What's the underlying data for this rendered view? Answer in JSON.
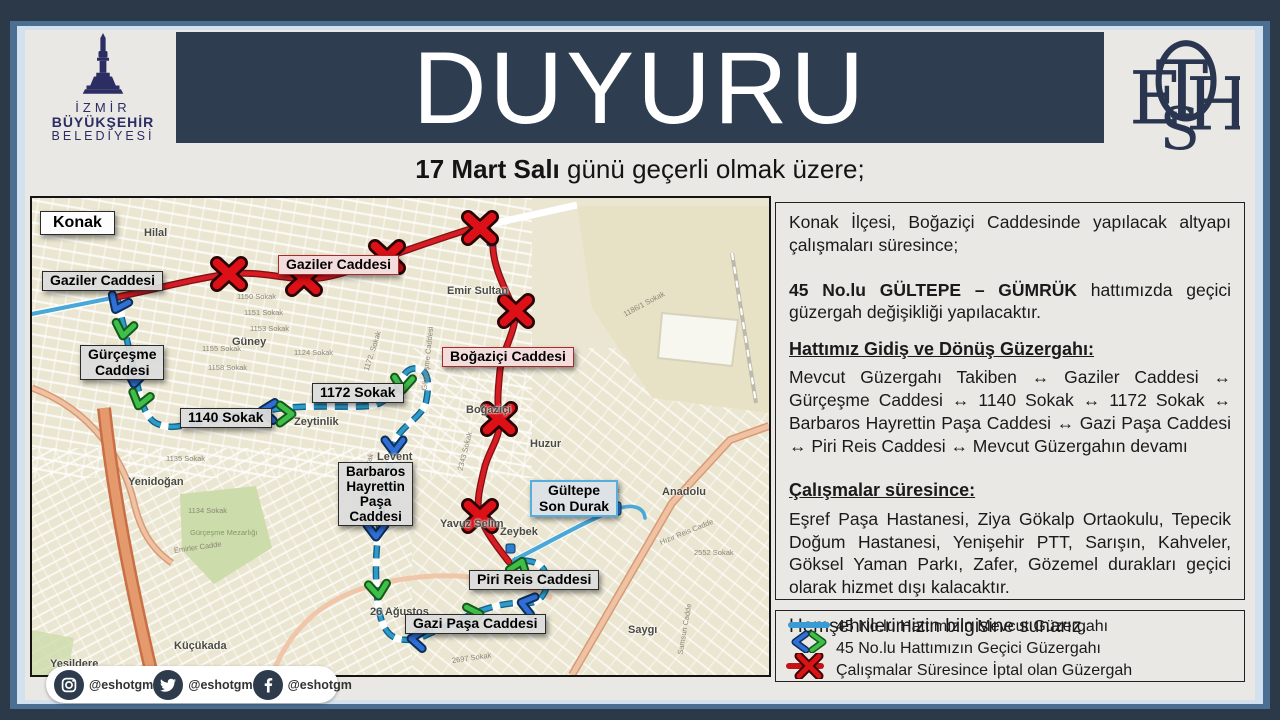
{
  "header": {
    "municipality": {
      "line1": "İZMİR",
      "line2": "BÜYÜKŞEHİR",
      "line3": "BELEDİYESİ"
    },
    "title": "DUYURU",
    "subtitle_bold": "17 Mart Salı",
    "subtitle_rest": " günü geçerli olmak üzere;",
    "eshot_letters": {
      "e": "E",
      "t": "T",
      "h": "H",
      "s": "S"
    }
  },
  "map": {
    "labels": {
      "konak": "Konak",
      "gaziler_left": "Gaziler Caddesi",
      "gaziler_center": "Gaziler Caddesi",
      "gurcesme": "Gürçeşme\nCaddesi",
      "sokak_1140": "1140 Sokak",
      "sokak_1172": "1172 Sokak",
      "bogazici": "Boğaziçi Caddesi",
      "barbaros": "Barbaros\nHayrettin\nPaşa\nCaddesi",
      "gultepe": "Gültepe\nSon Durak",
      "piri_reis": "Piri Reis Caddesi",
      "gazi_pasa": "Gazi Paşa Caddesi"
    },
    "places": [
      "Hilal",
      "Güney",
      "Emir Sultan",
      "Zeytinlik",
      "Levent",
      "Yenidoğan",
      "Küçükada",
      "Yeşildere",
      "Boğaziçi",
      "Huzur",
      "Anadolu",
      "Zeybek",
      "Yavuz Selim",
      "26 Ağustos",
      "Saygı"
    ],
    "streets": [
      "1150 Sokak",
      "1151 Sokak",
      "1153 Sokak",
      "1155 Sokak",
      "1158 Sokak",
      "1124 Sokak",
      "1135 Sokak",
      "1134 Sokak",
      "1172. Sokak",
      "Gürçeşme Caddesi",
      "Gürçeşme Mezarlığı",
      "2430 Sokak",
      "2552 Sokak",
      "Emirler Cadde",
      "1163 Sokak",
      "2343 Sokak",
      "1186/1 Sokak",
      "2697 Sokak",
      "Hızır Reis Cadde",
      "Samsun Cadde"
    ]
  },
  "panel": {
    "p1": "Konak İlçesi, Boğaziçi Caddesinde yapılacak altyapı çalışmaları süresince;",
    "p2_bold": "45 No.lu GÜLTEPE – GÜMRÜK",
    "p2_rest": " hattımızda geçici güzergah değişikliği yapılacaktır.",
    "h1": "Hattımız Gidiş ve Dönüş Güzergahı:",
    "route": "Mevcut Güzergahı Takiben ↔ Gaziler Caddesi ↔ Gürçeşme Caddesi ↔ 1140 Sokak ↔ 1172 Sokak ↔ Barbaros Hayrettin Paşa Caddesi ↔ Gazi Paşa Caddesi ↔ Piri Reis Caddesi ↔ Mevcut Güzergahın devamı",
    "h2": "Çalışmalar süresince:",
    "p4": "Eşref Paşa Hastanesi, Ziya Gökalp Ortaokulu, Tepecik Doğum Hastanesi, Yenişehir PTT, Sarışın, Kahveler, Göksel Yaman Parkı, Zafer, Gözemel durakları geçici olarak hizmet dışı kalacaktır.",
    "p5": "Hemşehrilerimizin bilgisine sunarız."
  },
  "legend": {
    "item1": "45 No.lu Hattımızın Mevcut Güzergahı",
    "item2": "45 No.lu Hattımızın Geçici Güzergahı",
    "item3": "Çalışmalar Süresince İptal olan Güzergah"
  },
  "social": {
    "instagram": "@eshotgm",
    "twitter": "@eshotgm",
    "facebook": "@eshotgm"
  },
  "colors": {
    "frame_navy": "#2b3949",
    "band_slate": "#2e3d50",
    "logo_navy": "#2b2d63",
    "route_cancelled_red": "#d81c24",
    "route_temp_blue": "#2f9cc8",
    "route_current_blue": "#49a8d8"
  }
}
